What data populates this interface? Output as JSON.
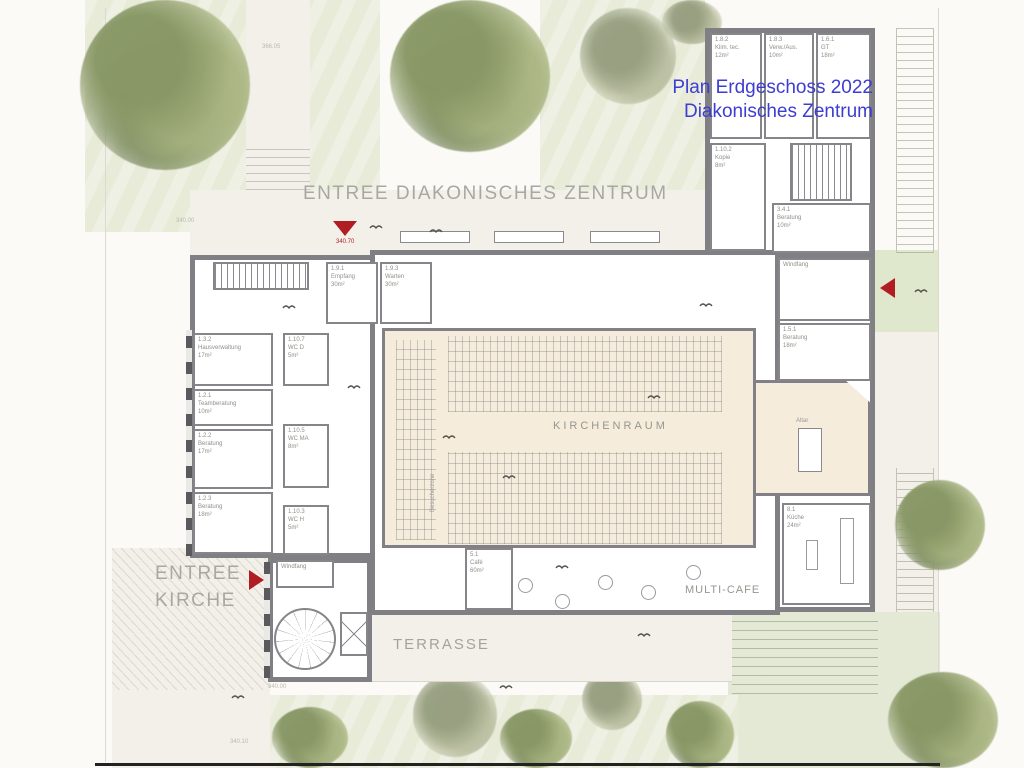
{
  "title": {
    "line1": "Plan Erdgeschoss 2022",
    "line2": "Diakonisches Zentrum"
  },
  "colors": {
    "title_blue": "#3d3dd2",
    "marker_red": "#b01d23",
    "wall_gray": "#7f7f84",
    "hall_beige": "#f5ecdc"
  },
  "big_labels": {
    "entree_dz": "ENTREE DIAKONISCHES ZENTRUM",
    "entree_kirche_line1": "ENTREE",
    "entree_kirche_line2": "KIRCHE",
    "kirchenraum": "KIRCHENRAUM",
    "multicafe": "MULTI-CAFE",
    "terrasse": "TERRASSE",
    "besucherzone": "Besucherzone",
    "altar": "Altar"
  },
  "elevations": {
    "top_path": "366.05",
    "left_lawn": "340.00",
    "entrance": "340.70",
    "bottom": "340.00",
    "bottom_left": "340.10"
  },
  "rooms": [
    {
      "id": "1.8.2",
      "name": "Klim. tec.",
      "area": "12m²"
    },
    {
      "id": "1.8.3",
      "name": "Verw./Aus.",
      "area": "10m²"
    },
    {
      "id": "1.6.1",
      "name": "GT",
      "area": "18m²"
    },
    {
      "id": "1.10.2",
      "name": "Kopie",
      "area": "8m²"
    },
    {
      "id": "3.4.1",
      "name": "Beratung",
      "area": "10m²"
    },
    {
      "id": "",
      "name": "Windfang",
      "area": ""
    },
    {
      "id": "1.5.1",
      "name": "Beratung",
      "area": "18m²"
    },
    {
      "id": "8.1",
      "name": "Küche",
      "area": "24m²"
    },
    {
      "id": "1.9.1",
      "name": "Empfang",
      "area": "30m²"
    },
    {
      "id": "1.9.3",
      "name": "Warten",
      "area": "30m²"
    },
    {
      "id": "1.3.2",
      "name": "Hausverwaltung",
      "area": "17m²"
    },
    {
      "id": "1.2.1",
      "name": "Teamberatung",
      "area": "10m²"
    },
    {
      "id": "1.2.2",
      "name": "Beratung",
      "area": "17m²"
    },
    {
      "id": "1.2.3",
      "name": "Beratung",
      "area": "18m²"
    },
    {
      "id": "1.10.7",
      "name": "WC D",
      "area": "5m²"
    },
    {
      "id": "1.10.5",
      "name": "WC MA",
      "area": "8m²"
    },
    {
      "id": "1.10.3",
      "name": "WC H",
      "area": "5m²"
    },
    {
      "id": "",
      "name": "Windfang",
      "area": ""
    },
    {
      "id": "5.1",
      "name": "Café",
      "area": "60m²"
    }
  ]
}
